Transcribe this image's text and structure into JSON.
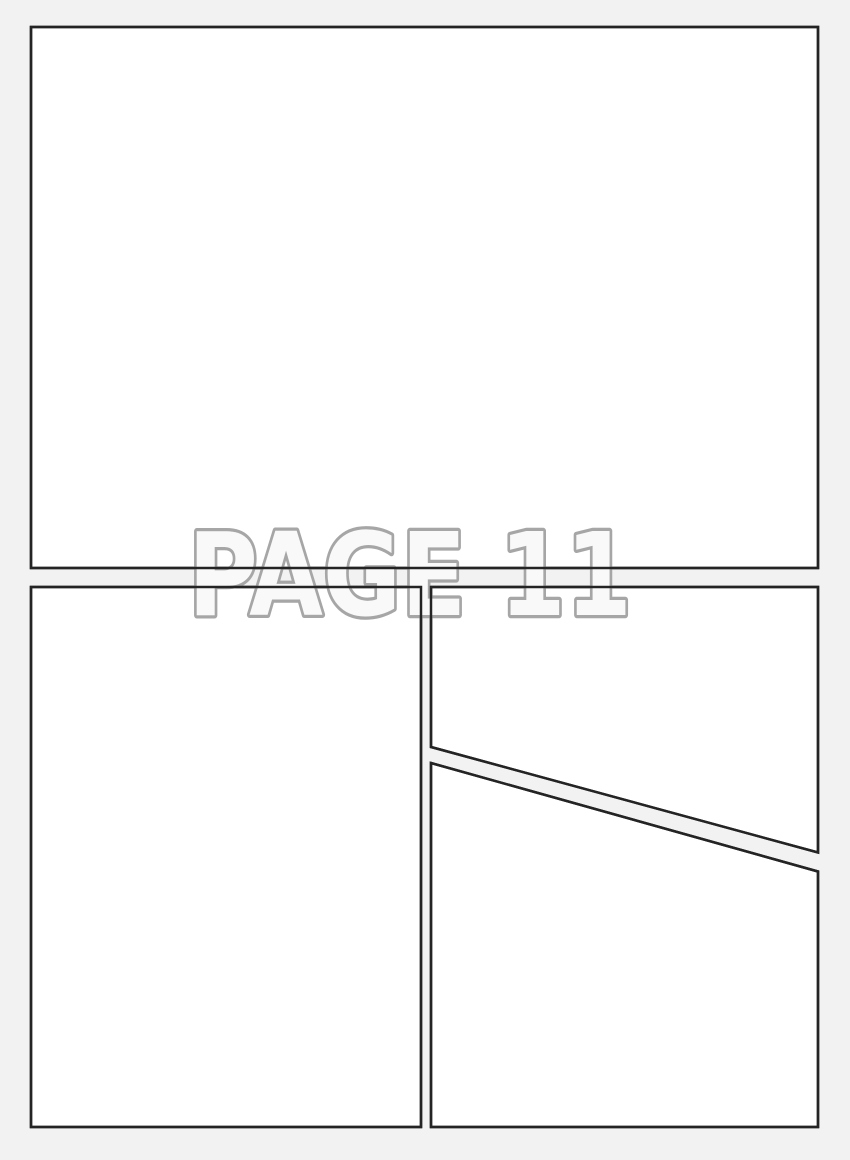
{
  "page": {
    "label": "PAGE 11"
  },
  "colors": {
    "background": "#f2f2f2",
    "panel_fill": "#ffffff",
    "panel_border": "#242424",
    "label_fill": "#f9f9f9",
    "label_outline": "#a6a6a6"
  },
  "panels": [
    {
      "id": "panel-top"
    },
    {
      "id": "panel-bottom-left"
    },
    {
      "id": "panel-bottom-right-upper"
    },
    {
      "id": "panel-bottom-right-lower"
    }
  ]
}
